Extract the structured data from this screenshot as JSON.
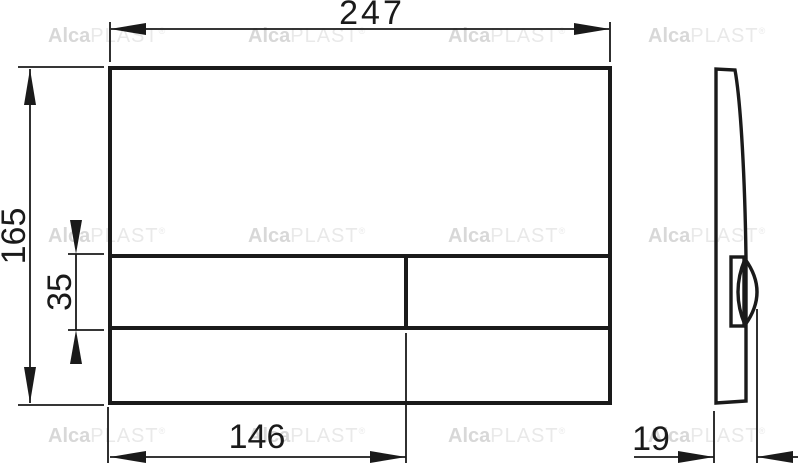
{
  "watermark": {
    "brand_bold": "Alca",
    "brand_light": "PLAST",
    "registered": "®"
  },
  "dimensions": {
    "plate_width": "247",
    "plate_height": "165",
    "button_strip_height": "35",
    "button_width": "146",
    "plate_depth": "19"
  },
  "colors": {
    "line": "#1a1a1a",
    "watermark_bold": "#d8d8d8",
    "watermark_light": "#e9e9e9",
    "background": "#ffffff"
  }
}
